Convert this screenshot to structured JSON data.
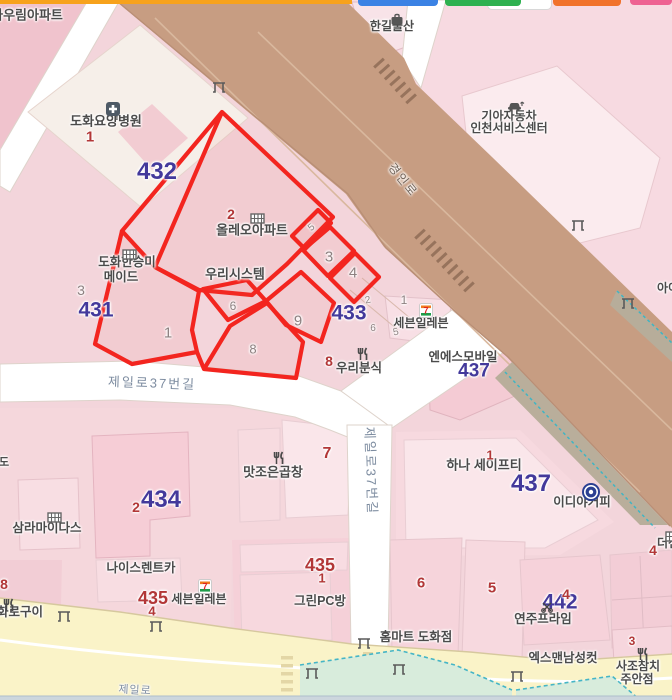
{
  "map": {
    "colors": {
      "place": "#4b4b4b",
      "block": "#43399b",
      "bnum": "#b23737",
      "pnum": "#8d8080",
      "road": "#7d8ca0",
      "roadb": "#6f6156",
      "parcel_overlay": "#f3251f",
      "main_road": "#c79d82",
      "minor_road": "#ffffff",
      "jeil_road": "#faf3c8",
      "green_area": "#d8ecdc",
      "green_border": "#45b5c6"
    },
    "top_pills": [
      {
        "n": "top-bar-orange",
        "x": 0,
        "w": 352,
        "h": 4,
        "r": 0,
        "c": "#f7a21c"
      },
      {
        "n": "pill-white",
        "x": 487,
        "w": 63,
        "h": 9,
        "r": 5,
        "c": "#ffffff",
        "b": "#d8d8d8"
      },
      {
        "n": "pill-blue",
        "x": 358,
        "w": 80,
        "h": 6,
        "r": 4,
        "c": "#3b82e4"
      },
      {
        "n": "pill-green",
        "x": 445,
        "w": 76,
        "h": 6,
        "r": 4,
        "c": "#2eb150"
      },
      {
        "n": "pill-orange",
        "x": 553,
        "w": 68,
        "h": 6,
        "r": 4,
        "c": "#f1722b"
      },
      {
        "n": "pill-pink",
        "x": 630,
        "w": 42,
        "h": 5,
        "r": 4,
        "c": "#ee6292"
      }
    ],
    "labels": [
      {
        "n": "naurim-apartment",
        "k": "place",
        "t": "나우림아파트",
        "x": 27,
        "y": 15,
        "s": 13
      },
      {
        "n": "hangil-mulsan",
        "k": "place",
        "t": "한길물산",
        "x": 392,
        "y": 26,
        "s": 12
      },
      {
        "n": "dohwa-hospital",
        "k": "place",
        "t": "도화요양병원",
        "x": 106,
        "y": 121,
        "s": 13
      },
      {
        "n": "kia-motors-line1",
        "k": "place",
        "t": "기아자동차",
        "x": 509,
        "y": 116,
        "s": 12
      },
      {
        "n": "kia-motors-line2",
        "k": "place",
        "t": "인천서비스센터",
        "x": 509,
        "y": 128,
        "s": 12
      },
      {
        "n": "olleo-apartment",
        "k": "place",
        "t": "올레오아파트",
        "x": 252,
        "y": 230,
        "s": 13
      },
      {
        "n": "woori-system",
        "k": "place",
        "t": "우리시스템",
        "x": 235,
        "y": 274,
        "s": 13
      },
      {
        "n": "dohwa-hanseungmi",
        "k": "place",
        "t": "도화한승미",
        "x": 127,
        "y": 262,
        "s": 12.5
      },
      {
        "n": "maid",
        "k": "place",
        "t": "메이드",
        "x": 121,
        "y": 277,
        "s": 12.5
      },
      {
        "n": "seven-eleven-north",
        "k": "place",
        "t": "세븐일레븐",
        "x": 421,
        "y": 323,
        "s": 12
      },
      {
        "n": "ns-mobile",
        "k": "place",
        "t": "엔에스모바일",
        "x": 463,
        "y": 357,
        "s": 12.5
      },
      {
        "n": "woori-bunsik",
        "k": "place",
        "t": "우리분식",
        "x": 359,
        "y": 368,
        "s": 12.5
      },
      {
        "n": "matjoeun-gopchang",
        "k": "place",
        "t": "맛조은곱창",
        "x": 273,
        "y": 472,
        "s": 13
      },
      {
        "n": "hana-safety",
        "k": "place",
        "t": "하나 세이프티",
        "x": 484,
        "y": 465,
        "s": 13
      },
      {
        "n": "ediya-coffee",
        "k": "place",
        "t": "이디야커피",
        "x": 582,
        "y": 502,
        "s": 12.5
      },
      {
        "n": "samra-midas",
        "k": "place",
        "t": "삼라마이다스",
        "x": 47,
        "y": 528,
        "s": 12.5
      },
      {
        "n": "nice-rentcar",
        "k": "place",
        "t": "나이스렌트카",
        "x": 141,
        "y": 568,
        "s": 12.5
      },
      {
        "n": "seven-eleven-south",
        "k": "place",
        "t": "세븐일레븐",
        "x": 199,
        "y": 599,
        "s": 12
      },
      {
        "n": "hwaro-gui",
        "k": "place",
        "t": "화로구이",
        "x": 20,
        "y": 612,
        "s": 12.5
      },
      {
        "n": "green-pc-bang",
        "k": "place",
        "t": "그린PC방",
        "x": 320,
        "y": 601,
        "s": 12.5
      },
      {
        "n": "homemart-dohwa",
        "k": "place",
        "t": "홈마트 도화점",
        "x": 416,
        "y": 637,
        "s": 12.5
      },
      {
        "n": "yeonju-prime",
        "k": "place",
        "t": "연주프라임",
        "x": 543,
        "y": 619,
        "s": 12.5
      },
      {
        "n": "xman-mens-cut",
        "k": "place",
        "t": "엑스맨남성컷",
        "x": 563,
        "y": 658,
        "s": 12.5
      },
      {
        "n": "sajo-chamchi-line1",
        "k": "place",
        "t": "사조참치",
        "x": 638,
        "y": 666,
        "s": 12
      },
      {
        "n": "sajo-chamchi-line2",
        "k": "place",
        "t": "주안점",
        "x": 637,
        "y": 679,
        "s": 12
      },
      {
        "n": "ai-partial",
        "k": "place",
        "t": "아이",
        "x": 668,
        "y": 288,
        "s": 12
      },
      {
        "n": "thejen-partial",
        "k": "place",
        "t": "더젠",
        "x": 668,
        "y": 543,
        "s": 12
      },
      {
        "n": "do-partial",
        "k": "place",
        "t": "도",
        "x": 4,
        "y": 463,
        "s": 11
      },
      {
        "n": "block-432",
        "k": "block",
        "t": "432",
        "x": 157,
        "y": 172,
        "s": 24
      },
      {
        "n": "block-431",
        "k": "block",
        "t": "431",
        "x": 96,
        "y": 310,
        "s": 21
      },
      {
        "n": "block-433",
        "k": "block",
        "t": "433",
        "x": 349,
        "y": 313,
        "s": 21
      },
      {
        "n": "block-434",
        "k": "block",
        "t": "434",
        "x": 161,
        "y": 500,
        "s": 24
      },
      {
        "n": "block-437-a",
        "k": "block",
        "t": "437",
        "x": 474,
        "y": 371,
        "s": 19
      },
      {
        "n": "block-437-b",
        "k": "block",
        "t": "437",
        "x": 531,
        "y": 484,
        "s": 24
      },
      {
        "n": "block-442",
        "k": "block",
        "t": "442",
        "x": 560,
        "y": 602,
        "s": 21
      },
      {
        "n": "bldg-1-hospital",
        "k": "bnum",
        "t": "1",
        "x": 90,
        "y": 137,
        "s": 15
      },
      {
        "n": "bldg-2-olleo",
        "k": "bnum",
        "t": "2",
        "x": 231,
        "y": 214,
        "s": 14
      },
      {
        "n": "bldg-8-bunsik",
        "k": "bnum",
        "t": "8",
        "x": 329,
        "y": 361,
        "s": 14
      },
      {
        "n": "bldg-7",
        "k": "bnum",
        "t": "7",
        "x": 327,
        "y": 454,
        "s": 16
      },
      {
        "n": "bldg-1-hana",
        "k": "bnum",
        "t": "1",
        "x": 490,
        "y": 455,
        "s": 13
      },
      {
        "n": "bldg-2-434",
        "k": "bnum",
        "t": "2",
        "x": 136,
        "y": 507,
        "s": 14
      },
      {
        "n": "bldg-435-mid",
        "k": "bnum",
        "t": "435",
        "x": 320,
        "y": 565,
        "s": 18
      },
      {
        "n": "bldg-1-435",
        "k": "bnum",
        "t": "1",
        "x": 322,
        "y": 578,
        "s": 13
      },
      {
        "n": "bldg-435-sw",
        "k": "bnum",
        "t": "435",
        "x": 153,
        "y": 598,
        "s": 18
      },
      {
        "n": "bldg-4-435",
        "k": "bnum",
        "t": "4",
        "x": 152,
        "y": 611,
        "s": 13
      },
      {
        "n": "bldg-6",
        "k": "bnum",
        "t": "6",
        "x": 421,
        "y": 583,
        "s": 15
      },
      {
        "n": "bldg-5",
        "k": "bnum",
        "t": "5",
        "x": 492,
        "y": 588,
        "s": 15
      },
      {
        "n": "bldg-4-442",
        "k": "bnum",
        "t": "4",
        "x": 566,
        "y": 594,
        "s": 14
      },
      {
        "n": "bldg-3-sajo",
        "k": "bnum",
        "t": "3",
        "x": 632,
        "y": 641,
        "s": 12
      },
      {
        "n": "bldg-8-edge",
        "k": "bnum",
        "t": "8",
        "x": 4,
        "y": 584,
        "s": 14
      },
      {
        "n": "bldg-4-thejen",
        "k": "bnum",
        "t": "4",
        "x": 653,
        "y": 550,
        "s": 14
      },
      {
        "n": "parcel-3-431",
        "k": "pnum",
        "t": "3",
        "x": 81,
        "y": 290,
        "s": 14
      },
      {
        "n": "parcel-1",
        "k": "pnum",
        "t": "1",
        "x": 168,
        "y": 333,
        "s": 15
      },
      {
        "n": "parcel-6",
        "k": "pnum",
        "t": "6",
        "x": 233,
        "y": 306,
        "s": 12
      },
      {
        "n": "parcel-9",
        "k": "pnum",
        "t": "9",
        "x": 298,
        "y": 321,
        "s": 15
      },
      {
        "n": "parcel-8",
        "k": "pnum",
        "t": "8",
        "x": 253,
        "y": 349,
        "s": 13
      },
      {
        "n": "parcel-3",
        "k": "pnum",
        "t": "3",
        "x": 329,
        "y": 257,
        "s": 15
      },
      {
        "n": "parcel-4",
        "k": "pnum",
        "t": "4",
        "x": 353,
        "y": 273,
        "s": 15
      },
      {
        "n": "parcel-5-sliver",
        "k": "pnum",
        "t": "5",
        "x": 312,
        "y": 228,
        "s": 10,
        "r": -40
      },
      {
        "n": "parcel-2-small",
        "k": "pnum",
        "t": "2",
        "x": 368,
        "y": 301,
        "s": 10,
        "r": -12
      },
      {
        "n": "parcel-1-small",
        "k": "pnum",
        "t": "1",
        "x": 404,
        "y": 300,
        "s": 12
      },
      {
        "n": "parcel-6-small",
        "k": "pnum",
        "t": "6",
        "x": 373,
        "y": 329,
        "s": 10
      },
      {
        "n": "parcel-5-small",
        "k": "pnum",
        "t": "5",
        "x": 396,
        "y": 333,
        "s": 10,
        "r": -12
      },
      {
        "n": "road-gyeongin",
        "k": "roadb",
        "t": "경인로",
        "x": 403,
        "y": 180,
        "s": 12,
        "r": 51,
        "ls": 2
      },
      {
        "n": "road-jeil37-h",
        "k": "road",
        "t": "제일로37번길",
        "x": 152,
        "y": 383,
        "s": 13,
        "r": 2,
        "ls": 2
      },
      {
        "n": "road-jeil37-v",
        "k": "road",
        "t": "제일로37번길",
        "x": 371,
        "y": 471,
        "s": 13,
        "r": 88,
        "ls": 2
      },
      {
        "n": "road-jeil-partial",
        "k": "road",
        "t": "제일로",
        "x": 135,
        "y": 691,
        "s": 11,
        "r": 3,
        "ls": 1
      }
    ],
    "icons": [
      {
        "n": "bag-icon",
        "x": 390,
        "y": 13
      },
      {
        "n": "hospital-icon",
        "x": 105,
        "y": 101
      },
      {
        "n": "apartment-icon",
        "x": 250,
        "y": 212
      },
      {
        "n": "apartment-icon",
        "x": 122,
        "y": 248
      },
      {
        "n": "car-icon",
        "x": 507,
        "y": 100
      },
      {
        "n": "seven-eleven-icon",
        "x": 419,
        "y": 303
      },
      {
        "n": "restaurant-icon",
        "x": 357,
        "y": 347
      },
      {
        "n": "restaurant-icon",
        "x": 273,
        "y": 451
      },
      {
        "n": "coffee-icon",
        "x": 581,
        "y": 482
      },
      {
        "n": "apartment-icon",
        "x": 47,
        "y": 511
      },
      {
        "n": "seven-eleven-icon",
        "x": 198,
        "y": 579
      },
      {
        "n": "restaurant-icon",
        "x": 3,
        "y": 598
      },
      {
        "n": "scissors-icon",
        "x": 541,
        "y": 601
      },
      {
        "n": "restaurant-icon",
        "x": 637,
        "y": 647
      },
      {
        "n": "apartment-icon",
        "x": 665,
        "y": 530
      },
      {
        "n": "gate-icon",
        "x": 212,
        "y": 81
      },
      {
        "n": "gate-icon",
        "x": 571,
        "y": 219
      },
      {
        "n": "gate-icon",
        "x": 621,
        "y": 297
      },
      {
        "n": "gate-icon",
        "x": 57,
        "y": 610
      },
      {
        "n": "gate-icon",
        "x": 149,
        "y": 620
      },
      {
        "n": "gate-icon",
        "x": 357,
        "y": 637
      },
      {
        "n": "gate-icon",
        "x": 392,
        "y": 663
      },
      {
        "n": "gate-icon",
        "x": 305,
        "y": 667
      },
      {
        "n": "gate-icon",
        "x": 510,
        "y": 670
      }
    ]
  }
}
